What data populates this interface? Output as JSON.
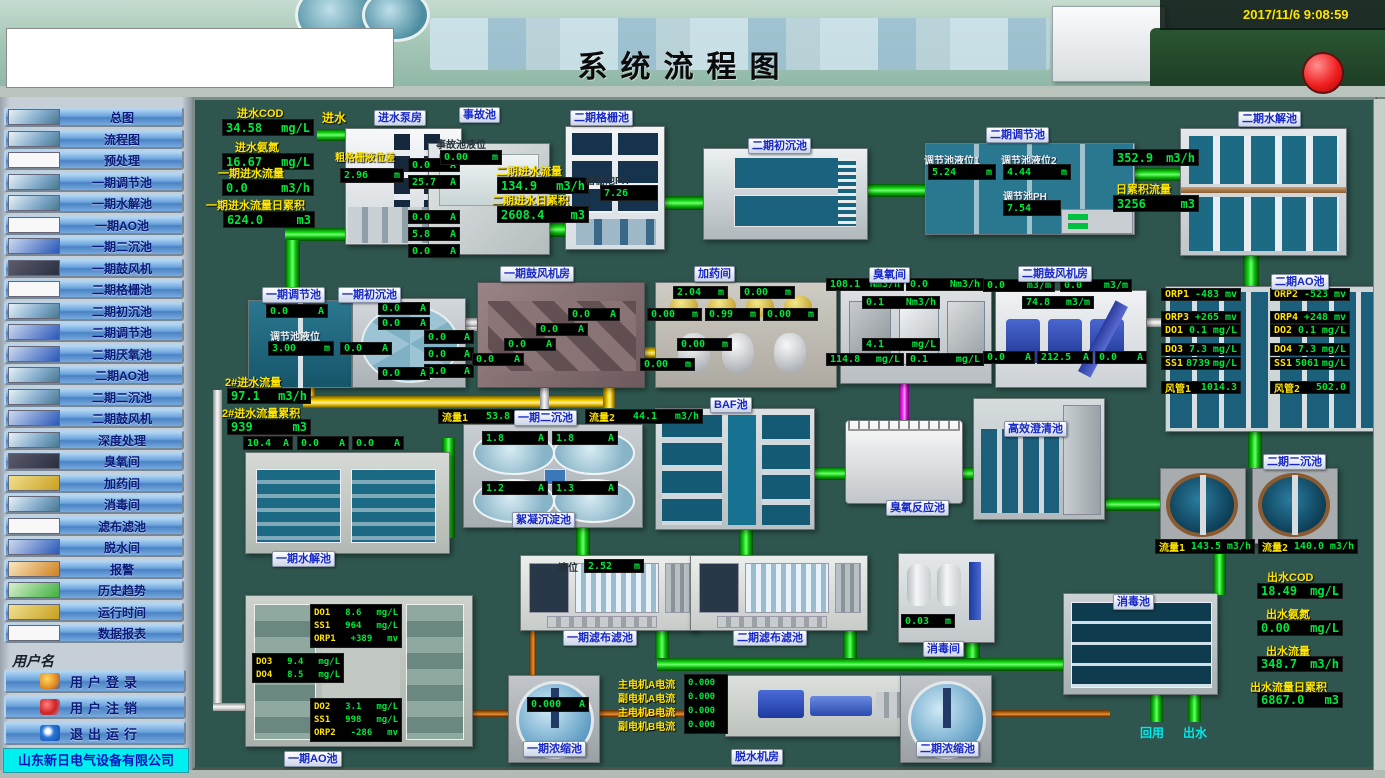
{
  "header": {
    "title": "系统流程图",
    "timestamp": "2017/11/6 9:08:59"
  },
  "sidebar": {
    "nav": [
      "总图",
      "流程图",
      "预处理",
      "一期调节池",
      "一期水解池",
      "一期AO池",
      "一期二沉池",
      "一期鼓风机",
      "二期格栅池",
      "二期初沉池",
      "二期调节池",
      "二期厌氧池",
      "二期AO池",
      "二期二沉池",
      "二期鼓风机",
      "深度处理",
      "臭氧间",
      "加药间",
      "消毒间",
      "滤布滤池",
      "脱水间",
      "报警",
      "历史趋势",
      "运行时间",
      "数据报表"
    ],
    "username_label": "用户名",
    "login": "用户登录",
    "logout": "用户注销",
    "exit": "退出运行",
    "company": "山东新日电气设备有限公司"
  },
  "units": {
    "a": "A",
    "m": "m",
    "mgl": "mg/L",
    "m3h": "m3/h",
    "m3": "m3",
    "mv": "mv",
    "nm3h": "Nm3/h",
    "m3m": "m3/m"
  },
  "colors": {
    "pipe_green": "#00d000",
    "pipe_yellow": "#ffd800",
    "pipe_magenta": "#ff30ff",
    "pipe_orange": "#c87018",
    "value_green": "#00e63c",
    "label_yellow": "#ffe400",
    "alarm_red": "#ee1010"
  },
  "diagram": {
    "inlet": {
      "cod_l": "进水COD",
      "cod": "34.58",
      "nh3_l": "进水氨氮",
      "nh3": "16.67",
      "f_l": "一期进水流量",
      "f": "0.0",
      "ft_l": "一期进水流量日累积",
      "ft": "624.0",
      "pipe_l": "进水"
    },
    "pump_house": {
      "label": "进水泵房",
      "grid_l": "粗格栅液位差",
      "grid": "2.96",
      "c": [
        "0.0",
        "25.7",
        "0.0",
        "5.8",
        "0.0"
      ]
    },
    "accident": {
      "label": "事故池",
      "lvl_l": "事故池液位",
      "lvl": "0.00",
      "c": [
        "0.0",
        "0.0",
        "0.0"
      ]
    },
    "p2_in": {
      "f_l": "二期进水流量",
      "f": "134.9",
      "ft_l": "二期进水日累积",
      "ft": "2608.4"
    },
    "grille2": {
      "label": "二期格栅池",
      "ph_l": "格栅池PH",
      "ph": "7.26"
    },
    "primary2": {
      "label": "二期初沉池"
    },
    "regulate2": {
      "label": "二期调节池",
      "l1_l": "调节池液位1",
      "l1": "5.24",
      "l2_l": "调节池液位2",
      "l2": "4.44",
      "ph_l": "调节池PH",
      "ph": "7.54"
    },
    "hydrolysis2": {
      "label": "二期水解池",
      "f": "352.9",
      "ft_l": "日累积流量",
      "ft": "3256"
    },
    "blower1": {
      "label": "一期鼓风机房",
      "c": [
        "0.0",
        "0.0",
        "0.0",
        "0.0"
      ]
    },
    "dosing": {
      "label": "加药间",
      "lv": [
        "2.04",
        "0.00",
        "0.00",
        "0.99",
        "0.00",
        "0.00",
        "0.00"
      ]
    },
    "ozone": {
      "label": "臭氧间",
      "v1": "108.1",
      "v2": "0.0",
      "v3": "0.1",
      "v4": "4.1",
      "v5": "114.8",
      "v6": "0.1"
    },
    "blower2": {
      "label": "二期鼓风机房",
      "f1": "0.0",
      "f2": "0.0",
      "f3": "74.8",
      "a1": "0.0",
      "a2": "212.5",
      "a3": "0.0"
    },
    "ao2": {
      "label": "二期AO池",
      "rows_l": [
        "ORP1",
        "ORP3",
        "DO1",
        "DO3",
        "SS1",
        "风管1"
      ],
      "rows_lv": [
        "-483",
        "+265",
        "0.1",
        "7.3",
        "8739",
        "1014.3"
      ],
      "rows_r": [
        "ORP2",
        "ORP4",
        "DO2",
        "DO4",
        "SS1",
        "风管2"
      ],
      "rows_rv": [
        "-523",
        "+248",
        "0.1",
        "7.3",
        "5061",
        "502.0"
      ]
    },
    "regulate1": {
      "label": "一期调节池",
      "a": "0.0",
      "lvl_l": "调节池液位",
      "lvl": "3.00"
    },
    "primary1": {
      "label": "一期初沉池",
      "c": [
        "0.0",
        "0.0",
        "0.0",
        "0.0"
      ]
    },
    "p2line": {
      "f_l": "2#进水流量",
      "f": "97.1",
      "ft_l": "2#进水流量累积",
      "ft": "939"
    },
    "hydrolysis1": {
      "label": "一期水解池",
      "c": [
        "10.4",
        "0.0",
        "0.0"
      ]
    },
    "secondary1": {
      "label": "一期二沉池",
      "sub": "絮凝沉淀池",
      "f1_l": "流量1",
      "f1": "53.8",
      "f2_l": "流量2",
      "f2": "44.1",
      "c": [
        "1.8",
        "1.8",
        "1.2",
        "1.3"
      ]
    },
    "baf": {
      "label": "BAF池"
    },
    "ozone_reactor": {
      "label": "臭氧反应池"
    },
    "hi_clarifier": {
      "label": "高效澄清池"
    },
    "secondary2": {
      "label": "二期二沉池",
      "f1_l": "流量1",
      "f1": "143.5",
      "f2_l": "流量2",
      "f2": "140.0"
    },
    "ao1": {
      "label": "一期AO池",
      "t_l": [
        "DO1",
        "SS1",
        "ORP1"
      ],
      "t_v": [
        "8.6",
        "964",
        "+389"
      ],
      "m_l": [
        "DO3",
        "DO4"
      ],
      "m_v": [
        "9.4",
        "8.5"
      ],
      "b_l": [
        "DO2",
        "SS1",
        "ORP2"
      ],
      "b_v": [
        "3.1",
        "998",
        "-286"
      ]
    },
    "filter1": {
      "label": "一期滤布滤池",
      "lvl_l": "液位",
      "lvl": "2.52"
    },
    "filter2": {
      "label": "二期滤布滤池"
    },
    "disinfect_room": {
      "label": "消毒间",
      "lvl": "0.03"
    },
    "disinfect_pool": {
      "label": "消毒池"
    },
    "thickener1": {
      "label": "一期浓缩池",
      "a": "0.000"
    },
    "dewater": {
      "label": "脱水机房",
      "r_l": [
        "主电机A电流",
        "副电机A电流",
        "主电机B电流",
        "副电机B电流"
      ],
      "r_v": [
        "0.000",
        "0.000",
        "0.000",
        "0.000"
      ]
    },
    "thickener2": {
      "label": "二期浓缩池"
    },
    "out": {
      "cod_l": "出水COD",
      "cod": "18.49",
      "nh3_l": "出水氨氮",
      "nh3": "0.00",
      "f_l": "出水流量",
      "f": "348.7",
      "ft_l": "出水流量日累积",
      "ft": "6867.0",
      "reuse": "回用",
      "outlet": "出水"
    }
  }
}
